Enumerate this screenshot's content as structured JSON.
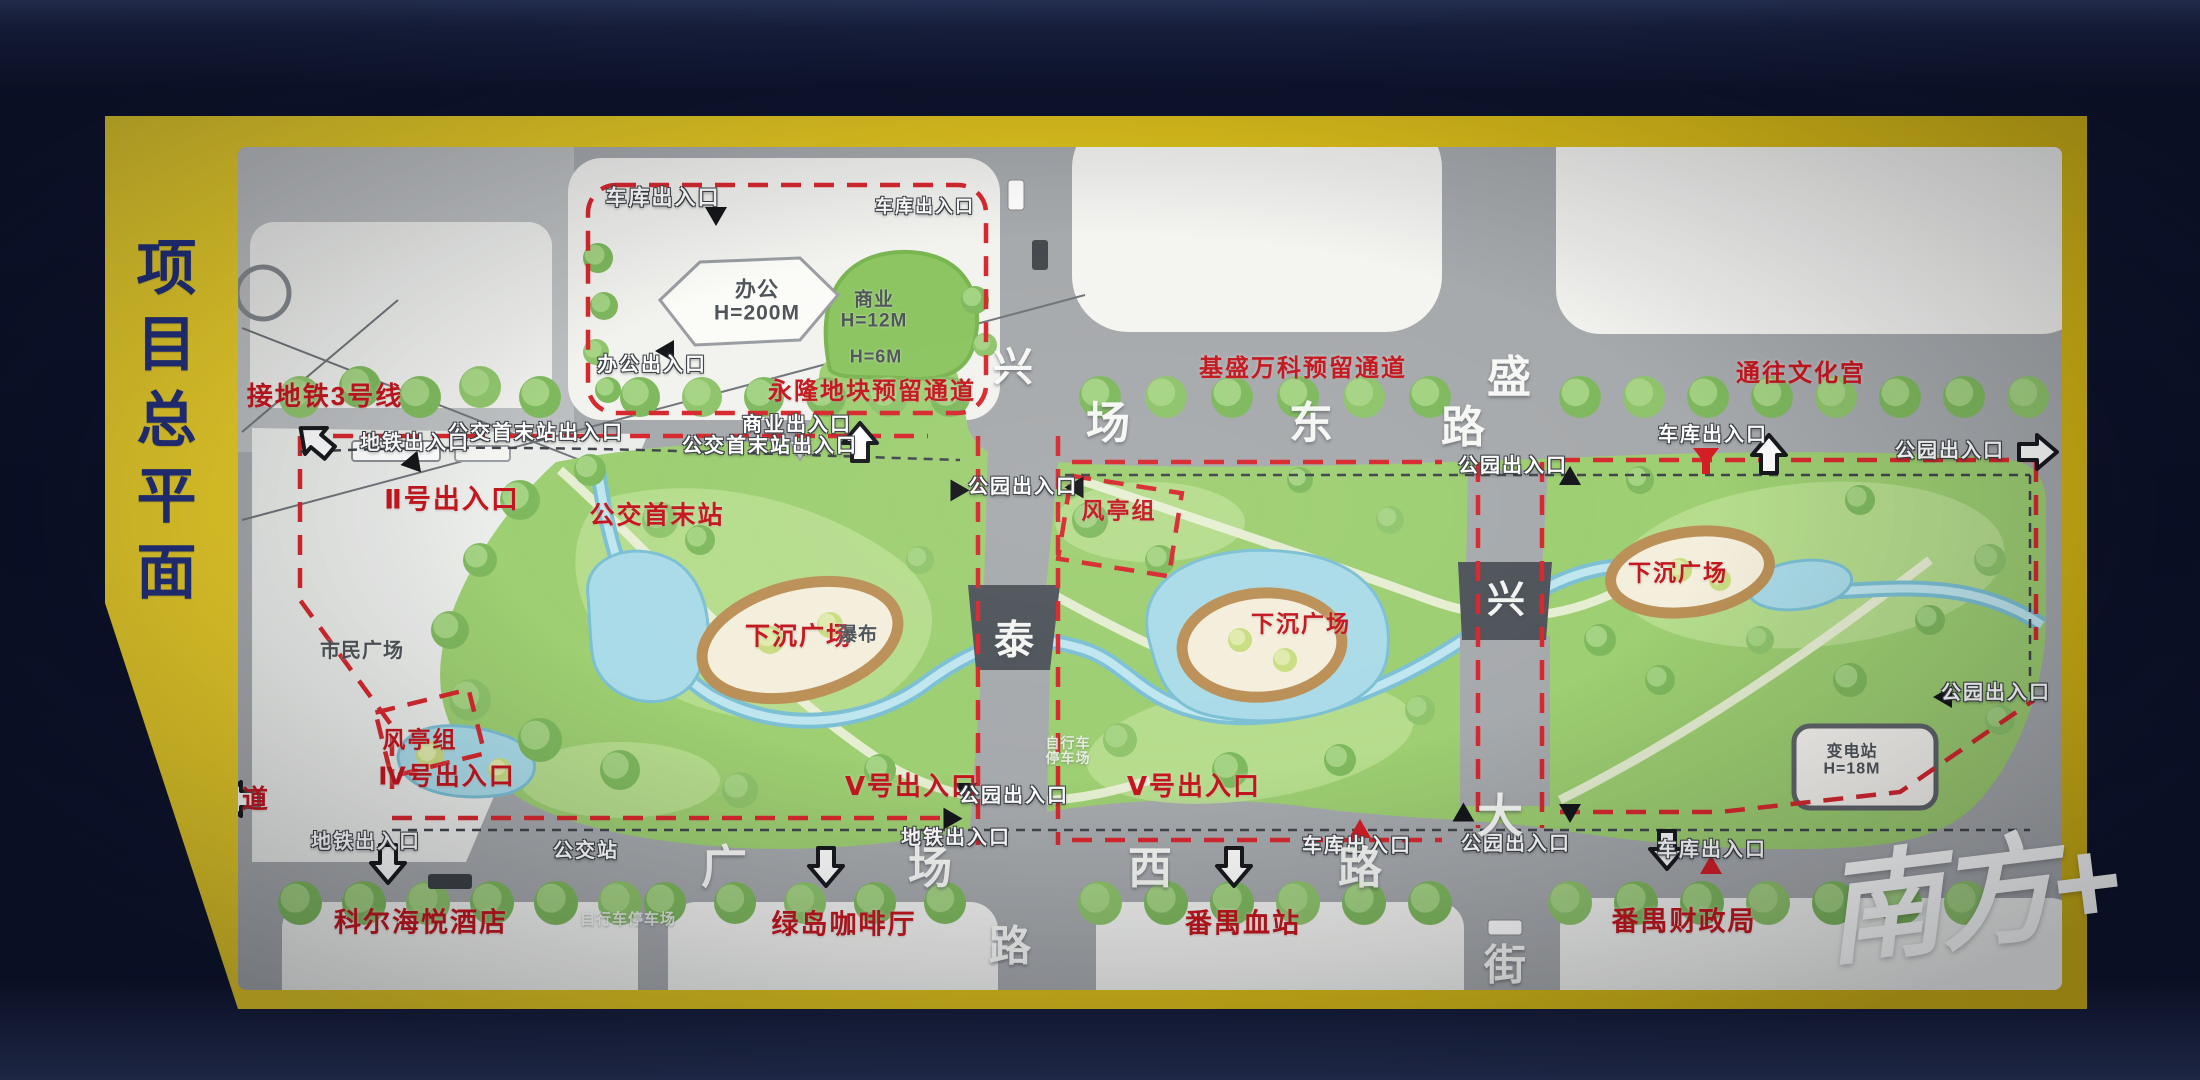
{
  "board": {
    "title": "项目总平面"
  },
  "watermark": {
    "text": "南方+"
  },
  "colors": {
    "board_yellow": "#e2c51f",
    "background_navy": "#0e142e",
    "title_blue": "#22307b",
    "label_red": "#c4161d",
    "park_green": "#9ecf72",
    "water_blue": "#aadbe8",
    "road_gray": "#a7aaad"
  },
  "map": {
    "labels": [
      {
        "name": "metro-line-3-label",
        "text": "接地铁3号线",
        "x": 325,
        "y": 396,
        "cls": "red",
        "fs": 26
      },
      {
        "name": "yonglong-reserved-passage-label",
        "text": "永隆地块预留通道",
        "x": 872,
        "y": 392,
        "cls": "red",
        "fs": 24
      },
      {
        "name": "jisheng-vanke-reserved-passage-label",
        "text": "基盛万科预留通道",
        "x": 1303,
        "y": 369,
        "cls": "red",
        "fs": 24
      },
      {
        "name": "to-culture-palace-label",
        "text": "通往文化宫",
        "x": 1801,
        "y": 374,
        "cls": "red",
        "fs": 24
      },
      {
        "name": "entrance-ii-label",
        "text": "Ⅱ号出入口",
        "x": 452,
        "y": 500,
        "cls": "red",
        "fs": 27
      },
      {
        "name": "bus-terminus-label",
        "text": "公交首末站",
        "x": 657,
        "y": 516,
        "cls": "red",
        "fs": 25
      },
      {
        "name": "wind-pavilion-group-top-label",
        "text": "风亭组",
        "x": 1119,
        "y": 511,
        "cls": "red",
        "fs": 23
      },
      {
        "name": "sunken-plaza-left-label",
        "text": "下沉广场",
        "x": 799,
        "y": 637,
        "cls": "red",
        "fs": 25
      },
      {
        "name": "sunken-plaza-center-label",
        "text": "下沉广场",
        "x": 1301,
        "y": 624,
        "cls": "red",
        "fs": 23
      },
      {
        "name": "sunken-plaza-right-label",
        "text": "下沉广场",
        "x": 1678,
        "y": 573,
        "cls": "red",
        "fs": 23
      },
      {
        "name": "wind-pavilion-group-left-label",
        "text": "风亭组",
        "x": 420,
        "y": 740,
        "cls": "red",
        "fs": 23
      },
      {
        "name": "entrance-iv-label",
        "text": "Ⅳ号出入口",
        "x": 447,
        "y": 777,
        "cls": "red",
        "fs": 25
      },
      {
        "name": "entrance-v-center-label",
        "text": "Ⅴ号出入口",
        "x": 912,
        "y": 786,
        "cls": "red",
        "fs": 26
      },
      {
        "name": "entrance-v-right-label",
        "text": "Ⅴ号出入口",
        "x": 1194,
        "y": 786,
        "cls": "red",
        "fs": 26
      },
      {
        "name": "kerl-haiyue-hotel-label",
        "text": "科尔海悦酒店",
        "x": 421,
        "y": 923,
        "cls": "red",
        "fs": 27
      },
      {
        "name": "green-island-cafe-label",
        "text": "绿岛咖啡厅",
        "x": 844,
        "y": 925,
        "cls": "red",
        "fs": 27
      },
      {
        "name": "panyu-blood-station-label",
        "text": "番禺血站",
        "x": 1243,
        "y": 924,
        "cls": "red",
        "fs": 27
      },
      {
        "name": "panyu-finance-bureau-label",
        "text": "番禺财政局",
        "x": 1684,
        "y": 922,
        "cls": "red",
        "fs": 27
      },
      {
        "name": "road-char-dao-red",
        "text": "道",
        "x": 256,
        "y": 799,
        "cls": "red",
        "fs": 26
      },
      {
        "name": "garage-entrance-top-label",
        "text": "车库出入口",
        "x": 663,
        "y": 199,
        "cls": "white",
        "fs": 21
      },
      {
        "name": "garage-entrance-top2-label",
        "text": "车库出入口",
        "x": 925,
        "y": 207,
        "cls": "white",
        "fs": 18
      },
      {
        "name": "office-entrance-label",
        "text": "办公出入口",
        "x": 652,
        "y": 366,
        "cls": "white",
        "fs": 20
      },
      {
        "name": "commercial-entrance-label",
        "text": "商业出入口",
        "x": 797,
        "y": 426,
        "cls": "white",
        "fs": 20
      },
      {
        "name": "bus-terminus-entrance-center-label",
        "text": "公交首末站出入口",
        "x": 770,
        "y": 447,
        "cls": "white",
        "fs": 20
      },
      {
        "name": "bus-terminus-entrance-left-label",
        "text": "公交首末站出入口",
        "x": 536,
        "y": 434,
        "cls": "white",
        "fs": 20
      },
      {
        "name": "metro-entrance-topleft-label",
        "text": "地铁出入口",
        "x": 415,
        "y": 444,
        "cls": "white",
        "fs": 20
      },
      {
        "name": "park-entrance-topcenter-label",
        "text": "公园出入口",
        "x": 1023,
        "y": 488,
        "cls": "white",
        "fs": 20
      },
      {
        "name": "park-entrance-topright-label",
        "text": "公园出入口",
        "x": 1513,
        "y": 467,
        "cls": "white",
        "fs": 20
      },
      {
        "name": "garage-entrance-topright-label",
        "text": "车库出入口",
        "x": 1713,
        "y": 436,
        "cls": "white",
        "fs": 20
      },
      {
        "name": "park-entrance-rightedge-top-label",
        "text": "公园出入口",
        "x": 1950,
        "y": 452,
        "cls": "white",
        "fs": 20
      },
      {
        "name": "park-entrance-rightedge-mid-label",
        "text": "公园出入口",
        "x": 1996,
        "y": 694,
        "cls": "white",
        "fs": 20
      },
      {
        "name": "metro-entrance-bottomleft-label",
        "text": "地铁出入口",
        "x": 366,
        "y": 843,
        "cls": "white",
        "fs": 20
      },
      {
        "name": "bus-stop-label",
        "text": "公交站",
        "x": 586,
        "y": 852,
        "cls": "white",
        "fs": 20
      },
      {
        "name": "metro-entrance-bottomcenter-label",
        "text": "地铁出入口",
        "x": 956,
        "y": 839,
        "cls": "white",
        "fs": 20
      },
      {
        "name": "park-entrance-bottomcenter-label",
        "text": "公园出入口",
        "x": 1014,
        "y": 797,
        "cls": "white",
        "fs": 20
      },
      {
        "name": "garage-entrance-bottomcenter-label",
        "text": "车库出入口",
        "x": 1357,
        "y": 847,
        "cls": "white",
        "fs": 20
      },
      {
        "name": "park-entrance-bottomright-label",
        "text": "公园出入口",
        "x": 1516,
        "y": 845,
        "cls": "white",
        "fs": 20
      },
      {
        "name": "garage-entrance-bottomright-label",
        "text": "车库出入口",
        "x": 1712,
        "y": 851,
        "cls": "white",
        "fs": 20
      },
      {
        "name": "road-char-xing-top",
        "text": "兴",
        "x": 1013,
        "y": 368,
        "cls": "road",
        "fs": 40
      },
      {
        "name": "road-char-chang-top",
        "text": "场",
        "x": 1108,
        "y": 424,
        "cls": "road",
        "fs": 44
      },
      {
        "name": "road-char-dong-top",
        "text": "东",
        "x": 1311,
        "y": 424,
        "cls": "road",
        "fs": 44
      },
      {
        "name": "road-char-sheng-top",
        "text": "盛",
        "x": 1509,
        "y": 378,
        "cls": "road",
        "fs": 44
      },
      {
        "name": "road-char-lu-topright",
        "text": "路",
        "x": 1463,
        "y": 428,
        "cls": "road",
        "fs": 44
      },
      {
        "name": "road-char-tai-bridge",
        "text": "泰",
        "x": 1014,
        "y": 641,
        "cls": "road",
        "fs": 40
      },
      {
        "name": "road-char-xing-bridge",
        "text": "兴",
        "x": 1506,
        "y": 601,
        "cls": "road",
        "fs": 38
      },
      {
        "name": "road-char-guang-bottom",
        "text": "广",
        "x": 724,
        "y": 868,
        "cls": "road",
        "fs": 46
      },
      {
        "name": "road-char-chang-bottom",
        "text": "场",
        "x": 930,
        "y": 869,
        "cls": "road",
        "fs": 44
      },
      {
        "name": "road-char-xi-bottom",
        "text": "西",
        "x": 1150,
        "y": 869,
        "cls": "road",
        "fs": 44
      },
      {
        "name": "road-char-lu-bottom",
        "text": "路",
        "x": 1360,
        "y": 869,
        "cls": "road",
        "fs": 44
      },
      {
        "name": "road-char-lu-south",
        "text": "路",
        "x": 1010,
        "y": 946,
        "cls": "road",
        "fs": 42
      },
      {
        "name": "road-char-da-right",
        "text": "大",
        "x": 1500,
        "y": 817,
        "cls": "road",
        "fs": 46
      },
      {
        "name": "road-char-jie-right",
        "text": "街",
        "x": 1505,
        "y": 965,
        "cls": "road",
        "fs": 42
      },
      {
        "name": "office-building-label",
        "text": "办公\nH=200M",
        "x": 757,
        "y": 302,
        "cls": "dark",
        "fs": 21
      },
      {
        "name": "commercial-building-label",
        "text": "商业\nH=12M",
        "x": 874,
        "y": 311,
        "cls": "dark",
        "fs": 19
      },
      {
        "name": "height-6m-label",
        "text": "H=6M",
        "x": 876,
        "y": 357,
        "cls": "dark",
        "fs": 18
      },
      {
        "name": "waterfall-label",
        "text": "瀑布",
        "x": 858,
        "y": 636,
        "cls": "dark",
        "fs": 19
      },
      {
        "name": "citizens-square-label",
        "text": "市民广场",
        "x": 362,
        "y": 652,
        "cls": "dark",
        "fs": 20
      },
      {
        "name": "substation-label",
        "text": "变电站\nH=18M",
        "x": 1852,
        "y": 761,
        "cls": "dark",
        "fs": 16
      },
      {
        "name": "bicycle-parking-center-label",
        "text": "自行车\n停车场",
        "x": 1068,
        "y": 751,
        "cls": "faint",
        "fs": 14
      },
      {
        "name": "bicycle-parking-bottom-label",
        "text": "自行车停车场",
        "x": 628,
        "y": 920,
        "cls": "faint",
        "fs": 15
      }
    ],
    "arrows": [
      {
        "name": "metro-direction-arrow",
        "type": "block",
        "x": 316,
        "y": 441,
        "rot": -50
      },
      {
        "name": "park-entrance-arrow-top-center",
        "type": "block",
        "x": 860,
        "y": 443,
        "rot": 0
      },
      {
        "name": "park-entrance-arrow-top-right",
        "type": "block",
        "x": 1769,
        "y": 455,
        "rot": 0
      },
      {
        "name": "park-entrance-arrow-right-edge",
        "type": "block",
        "x": 2037,
        "y": 452,
        "rot": 90
      },
      {
        "name": "metro-exit-arrow-bottom-left",
        "type": "block",
        "x": 388,
        "y": 863,
        "rot": 180
      },
      {
        "name": "park-entrance-arrow-bottom-center",
        "type": "block",
        "x": 826,
        "y": 866,
        "rot": 180
      },
      {
        "name": "park-entrance-arrow-bottom-right",
        "type": "block",
        "x": 1234,
        "y": 866,
        "rot": 180
      },
      {
        "name": "garage-entrance-arrow-bottom-right",
        "type": "block",
        "x": 1667,
        "y": 849,
        "rot": 180
      },
      {
        "name": "road-direction-arrow-left-edge",
        "type": "block",
        "x": 241,
        "y": 799,
        "rot": -90
      },
      {
        "name": "garage-entrance-marker-top",
        "type": "tri",
        "x": 716,
        "y": 215,
        "rot": 180
      },
      {
        "name": "office-entrance-marker",
        "type": "tri",
        "x": 666,
        "y": 351,
        "rot": -90
      },
      {
        "name": "metro-entrance-marker-top-left",
        "type": "tri",
        "x": 414,
        "y": 464,
        "rot": 140
      },
      {
        "name": "park-entrance-marker-center-left",
        "type": "tri",
        "x": 956,
        "y": 489,
        "rot": -30
      },
      {
        "name": "park-entrance-marker-center-right",
        "type": "tri",
        "x": 1078,
        "y": 486,
        "rot": 30
      },
      {
        "name": "park-entrance-marker-top-right",
        "type": "tri",
        "x": 1570,
        "y": 477,
        "rot": 0
      },
      {
        "name": "park-entrance-marker-right-edge",
        "type": "tri",
        "x": 1944,
        "y": 697,
        "rot": -90
      },
      {
        "name": "entrance-v-marker-upper",
        "type": "tri",
        "x": 966,
        "y": 791,
        "rot": 180
      },
      {
        "name": "entrance-v-marker-lower",
        "type": "tri",
        "x": 949,
        "y": 820,
        "rot": 210
      },
      {
        "name": "park-entrance-marker-bottomright-a",
        "type": "tri",
        "x": 1462,
        "y": 816,
        "rot": -120
      },
      {
        "name": "park-entrance-marker-bottomright-b",
        "type": "tri",
        "x": 1570,
        "y": 812,
        "rot": 180
      },
      {
        "name": "commercial-entrance-marker",
        "type": "tri-white",
        "x": 800,
        "y": 449,
        "rot": 180
      },
      {
        "name": "garage-marker-top-right",
        "type": "funnel",
        "x": 1706,
        "y": 458,
        "rot": 0
      },
      {
        "name": "garage-marker-bottom-center",
        "type": "tri-red",
        "x": 1360,
        "y": 830,
        "rot": 0
      },
      {
        "name": "garage-marker-bottom-right",
        "type": "tri-red",
        "x": 1711,
        "y": 866,
        "rot": 0
      }
    ]
  }
}
